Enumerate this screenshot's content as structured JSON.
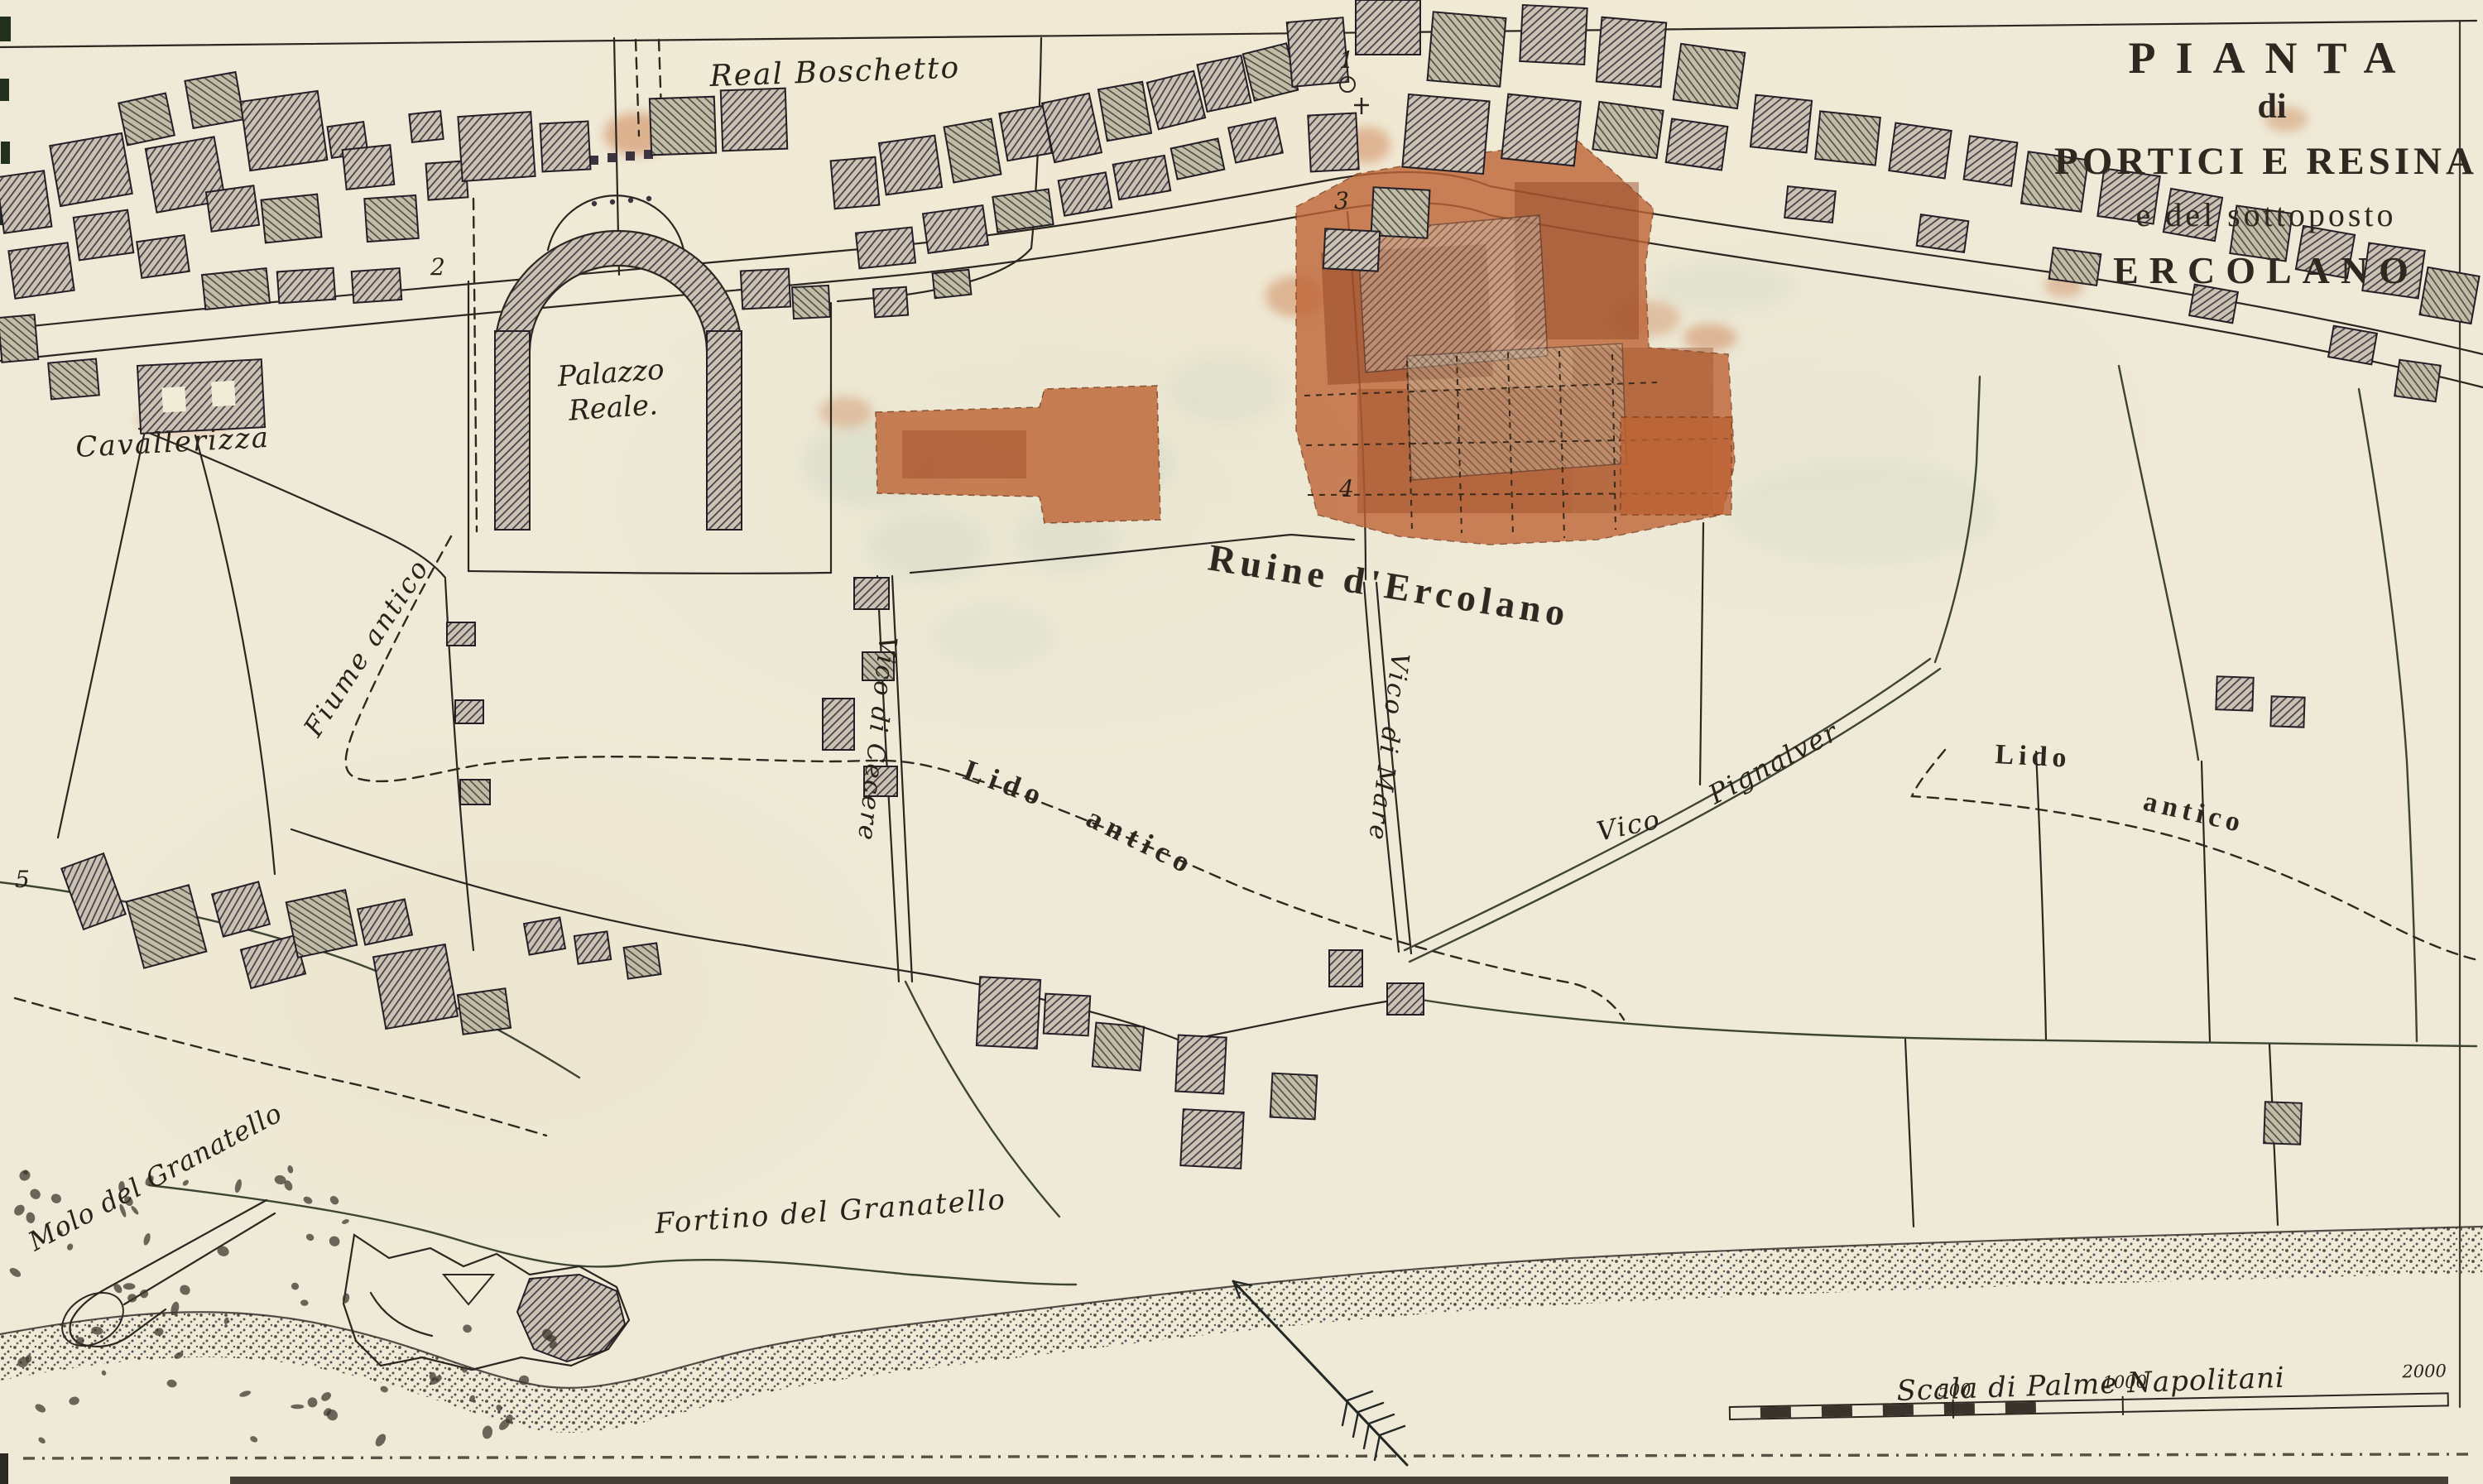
{
  "map": {
    "title": {
      "line1": "PIANTA",
      "line2": "di",
      "line3": "PORTICI E RESINA",
      "line4": "e del sottoposto",
      "line5": "ERCOLANO"
    },
    "labels": {
      "real_boschetto": "Real Boschetto",
      "palazzo_line1": "Palazzo",
      "palazzo_line2": "Reale.",
      "cavallerizza": "Cavallerizza",
      "ruine": "Ruine d'Ercolano",
      "fiume_antico": "Fiume antico",
      "vico_di_cecere": "Vico di Cecere",
      "vico_di_mare": "Vico di Mare",
      "vico": "Vico",
      "pignalver": "Pignalver",
      "lido_center": "Lido",
      "antico_center": "antico",
      "lido_right": "Lido",
      "antico_right": "antico",
      "molo": "Molo del Granatello",
      "fortino": "Fortino del Granatello"
    },
    "markers": {
      "m1": "1",
      "m2": "2",
      "m3": "3",
      "m4": "4",
      "m5": "5"
    },
    "scale": {
      "caption": "Scala di Palme Napolitani",
      "tick_500": "500",
      "tick_1000": "1000",
      "tick_2000": "2000"
    },
    "colors": {
      "parchment": "#efead7",
      "ink": "#2b241c",
      "building_hatch": "#473f4e",
      "ruins_red": "#bf6436",
      "title_ink": "#2f2821"
    }
  }
}
